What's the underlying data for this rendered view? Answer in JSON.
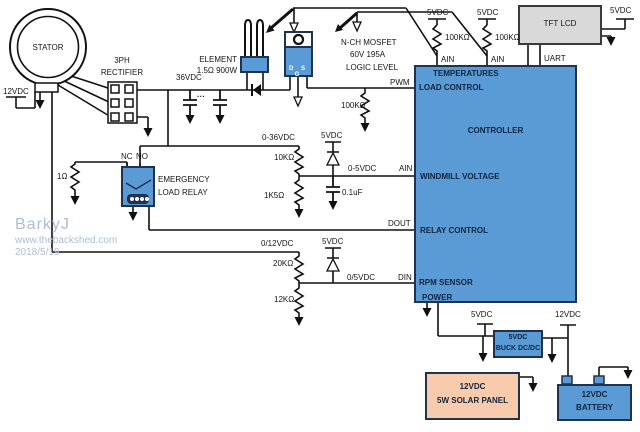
{
  "colors": {
    "component_blue": "#5b9bd5",
    "component_border": "#1f3250",
    "lcd_gray": "#d9d9d9",
    "panel_peach": "#f8cbad",
    "wire": "#111111",
    "watermark": "#aebdd2"
  },
  "stator": {
    "label": "STATOR",
    "supply_12v": "12VDC"
  },
  "rectifier": {
    "name1": "3PH",
    "name2": "RECTIFIER",
    "output_label": "36VDC",
    "caps_more": "···"
  },
  "element": {
    "name": "ELEMENT",
    "rating": "1.5Ω 900W"
  },
  "mosfet": {
    "name": "N-CH MOSFET",
    "rating": "60V 195A",
    "type": "LOGIC LEVEL",
    "pins": "D S G",
    "gate_label": "PWM",
    "pulldown": "100KΩ"
  },
  "temperature_inputs": {
    "supply_a": "5VDC",
    "resistor_a": "100KΩ",
    "pin_a": "AIN",
    "supply_b": "5VDC",
    "resistor_b": "100KΩ",
    "pin_b": "AIN"
  },
  "tft": {
    "name": "TFT LCD",
    "supply": "5VDC",
    "bus": "UART"
  },
  "controller": {
    "name": "CONTROLLER",
    "pins": {
      "temperatures": "TEMPERATURES",
      "load_control": "LOAD CONTROL",
      "windmill_voltage": "WINDMILL VOLTAGE",
      "relay_control": "RELAY CONTROL",
      "rpm_sensor": "RPM SENSOR",
      "power": "POWER"
    }
  },
  "relay": {
    "nc": "NC",
    "no": "NO",
    "name1": "EMERGENCY",
    "name2": "LOAD RELAY",
    "dump_resistor": "1Ω"
  },
  "windmill_sense": {
    "input": "0-36VDC",
    "r1": "10KΩ",
    "r2": "1K5Ω",
    "clamp_supply": "5VDC",
    "output": "0-5VDC",
    "pin": "AIN",
    "filter_cap": "0.1uF",
    "relay_pin": "DOUT"
  },
  "rpm_sense": {
    "input": "0/12VDC",
    "r1": "20KΩ",
    "r2": "12KΩ",
    "clamp_supply": "5VDC",
    "output": "0/5VDC",
    "pin": "DIN"
  },
  "power": {
    "rail_5v": "5VDC",
    "rail_12v": "12VDC",
    "buck1": "5VDC",
    "buck2": "BUCK DC/DC",
    "panel1": "12VDC",
    "panel2": "5W SOLAR PANEL",
    "battery1": "12VDC",
    "battery2": "BATTERY"
  },
  "watermark": {
    "author": "BarkyJ",
    "site": "www.thebackshed.com",
    "date": "2018/5/19"
  }
}
